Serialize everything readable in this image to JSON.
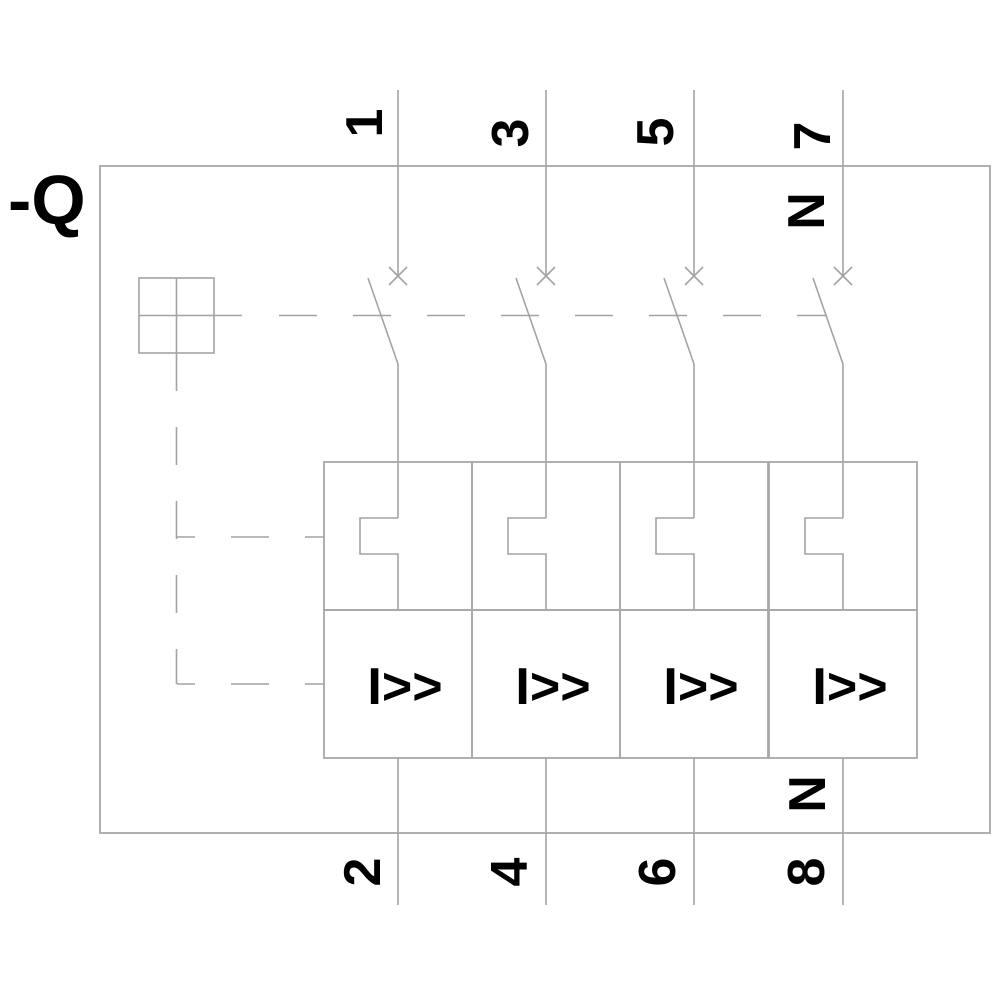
{
  "colors": {
    "line": "#a3a3a3",
    "text": "#000000",
    "background": "#ffffff"
  },
  "device": {
    "reference_label": "-Q"
  },
  "poles": [
    {
      "top_terminal": "1",
      "bottom_terminal": "2",
      "magnetic_trip_label": "I>>"
    },
    {
      "top_terminal": "3",
      "bottom_terminal": "4",
      "magnetic_trip_label": "I>>"
    },
    {
      "top_terminal": "5",
      "bottom_terminal": "6",
      "magnetic_trip_label": "I>>"
    },
    {
      "top_terminal": "7",
      "bottom_terminal": "8",
      "magnetic_trip_label": "I>>",
      "neutral_label_top": "N",
      "neutral_label_bottom": "N"
    }
  ]
}
